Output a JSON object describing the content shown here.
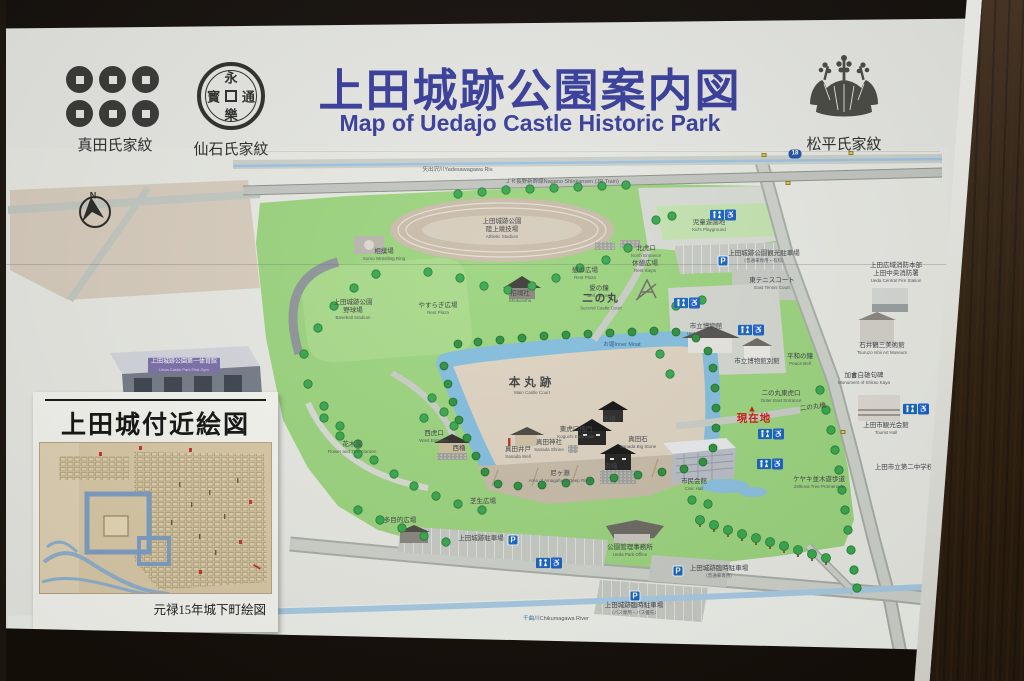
{
  "header": {
    "title": "上田城跡公園案内図",
    "subtitle": "Map of Uedajo Castle Historic Park",
    "title_color": "#383d9b",
    "crests": [
      {
        "id": "sanada",
        "label": "真田氏家紋"
      },
      {
        "id": "sengoku",
        "label": "仙石氏家紋",
        "coin": {
          "top": "永",
          "right": "通",
          "bottom": "樂",
          "left": "寳"
        }
      },
      {
        "id": "matsudaira",
        "label": "松平氏家紋"
      }
    ]
  },
  "inset": {
    "title": "上田城付近絵図",
    "caption": "元禄15年城下町絵図"
  },
  "colors": {
    "title_blue": "#383d9b",
    "park_green": "#9bd47e",
    "water_blue": "#84bede",
    "parking_blue": "#1766bf",
    "here_red": "#c81d10",
    "wood_brown": "#3b2b1c"
  },
  "map": {
    "parking_letter": "P",
    "wheelchair_icon": "♿",
    "you_are_here_marker": "▲",
    "route_shield": {
      "text": "18",
      "x": 795,
      "y": 154
    },
    "parkings": [
      {
        "x": 513,
        "y": 540
      },
      {
        "x": 678,
        "y": 571
      },
      {
        "x": 635,
        "y": 596
      },
      {
        "x": 723,
        "y": 261
      }
    ],
    "toilets": [
      {
        "x": 723,
        "y": 215
      },
      {
        "x": 687,
        "y": 303
      },
      {
        "x": 751,
        "y": 330
      },
      {
        "x": 771,
        "y": 434
      },
      {
        "x": 770,
        "y": 464
      },
      {
        "x": 549,
        "y": 563
      },
      {
        "x": 916,
        "y": 409
      }
    ],
    "signals": [
      {
        "x": 764,
        "y": 155
      },
      {
        "x": 851,
        "y": 153
      },
      {
        "x": 788,
        "y": 183
      },
      {
        "x": 843,
        "y": 432
      }
    ],
    "marker": {
      "x": 752,
      "y": 409
    },
    "labels": [
      {
        "jp": "N",
        "x": 93,
        "y": 196,
        "cls": "cn",
        "name": "compass-north-label"
      },
      {
        "jp": "矢出沢川",
        "en": "Yadesawagawa Riv.",
        "x": 458,
        "y": 167,
        "cls": "inline rd",
        "name": "river-road-label"
      },
      {
        "jp": "ＪＲ長野新幹線",
        "en": "Nagano Shinkansen (JR Train)",
        "x": 562,
        "y": 179,
        "cls": "inline rd",
        "name": "railway-label"
      },
      {
        "jp": "上田城跡公園",
        "jp2": "陸上競技場",
        "en": "Athletic Stadium",
        "x": 502,
        "y": 229
      },
      {
        "jp": "相撲場",
        "en": "Sumo Wrestling Ring",
        "x": 384,
        "y": 255
      },
      {
        "jp": "上田城跡公園",
        "jp2": "野球場",
        "en": "Baseball Stadium",
        "x": 353,
        "y": 310
      },
      {
        "jp": "やすらぎ広場",
        "en": "Rest Plaza",
        "x": 438,
        "y": 309
      },
      {
        "jp": "憩の広場",
        "en": "Rest Plaza",
        "x": 585,
        "y": 274
      },
      {
        "jp": "北虎口",
        "en": "North Entrance",
        "x": 646,
        "y": 252
      },
      {
        "jp": "休憩広場",
        "en": "Rest Steps",
        "x": 645,
        "y": 267
      },
      {
        "jp": "愛の鐘",
        "en": "Bell of Love",
        "x": 599,
        "y": 292
      },
      {
        "jp": "招魂社",
        "en": "Shokonsha",
        "x": 520,
        "y": 297
      },
      {
        "jp": "二の丸",
        "en": "Second Castle Court",
        "x": 601,
        "y": 302,
        "cls": "big"
      },
      {
        "jp": "お堀",
        "en": "Inner Moat",
        "x": 622,
        "y": 342,
        "cls": "inline wat"
      },
      {
        "jp": "本丸跡",
        "en": "Main Castle Court",
        "x": 532,
        "y": 386,
        "cls": "big sp"
      },
      {
        "jp": "西虎口",
        "en": "West Entrance",
        "x": 434,
        "y": 437
      },
      {
        "jp": "西櫓",
        "x": 459,
        "y": 449
      },
      {
        "jp": "真田神社",
        "en": "Sanada Shrine",
        "x": 549,
        "y": 446
      },
      {
        "jp": "真田井戸",
        "en": "Sanada Well",
        "x": 518,
        "y": 453
      },
      {
        "jp": "東虎口櫓門",
        "en": "Koguchi East Gate",
        "x": 576,
        "y": 433
      },
      {
        "jp": "北櫓",
        "x": 609,
        "y": 420
      },
      {
        "jp": "南櫓",
        "x": 611,
        "y": 467
      },
      {
        "jp": "真田石",
        "en": "Sanada Big Stone",
        "x": 638,
        "y": 443
      },
      {
        "jp": "尼ヶ淵",
        "en": "Area of Amagafuchi Deep River",
        "x": 560,
        "y": 477,
        "cls": "w64"
      },
      {
        "jp": "芝生広場",
        "x": 483,
        "y": 502
      },
      {
        "jp": "花木園",
        "en": "Flower and Tree Garden",
        "x": 352,
        "y": 448,
        "cls": "w64"
      },
      {
        "jp": "多目的広場",
        "x": 400,
        "y": 521
      },
      {
        "jp": "上田城跡駐車場",
        "x": 481,
        "y": 539
      },
      {
        "jp": "公園管理事務所",
        "en": "Ueda Park Office",
        "x": 630,
        "y": 551
      },
      {
        "jp": "上田城跡臨時駐車場",
        "en": "（バス専用・バス優先）",
        "x": 634,
        "y": 609
      },
      {
        "jp": "上田城跡臨時駐車場",
        "en": "（普通車専用）",
        "x": 719,
        "y": 572
      },
      {
        "jp": "千曲川",
        "en": "Chikumagawa River",
        "x": 556,
        "y": 616,
        "cls": "inline riv",
        "name": "chikuma-river-label"
      },
      {
        "jp": "児童遊園地",
        "en": "Kid's Playground",
        "x": 709,
        "y": 226
      },
      {
        "jp": "上田城跡公園観光駐車場",
        "en": "（普通車専用・有料）",
        "x": 764,
        "y": 257,
        "cls": "w74"
      },
      {
        "jp": "東テニスコート",
        "en": "East Tennis Court",
        "x": 772,
        "y": 284
      },
      {
        "jp": "市立博物館",
        "en": "Ueda City Museum",
        "x": 706,
        "y": 330
      },
      {
        "jp": "市立博物館別館",
        "x": 757,
        "y": 362
      },
      {
        "jp": "平和の鐘",
        "en": "Peace Bell",
        "x": 800,
        "y": 360
      },
      {
        "jp": "上田広域消防本部",
        "jp2": "上田中央消防署",
        "en": "Ueda Central Fire Station",
        "x": 896,
        "y": 273
      },
      {
        "jp": "石井鶴三美術館",
        "en": "Tsuruzo Ishii Art Museum",
        "x": 882,
        "y": 349,
        "cls": "w64"
      },
      {
        "jp": "加舎白雄句碑",
        "en": "Monument of Shirao Kaya",
        "x": 864,
        "y": 379,
        "cls": "w64"
      },
      {
        "jp": "上田市観光会館",
        "en": "Tourist Hall",
        "x": 886,
        "y": 429
      },
      {
        "jp": "上田市立第二中学校",
        "x": 904,
        "y": 468
      },
      {
        "jp": "現在地",
        "x": 754,
        "y": 419,
        "cls": "here",
        "name": "you-are-here-label"
      },
      {
        "jp": "二の丸橋",
        "x": 813,
        "y": 408,
        "cls": "rot"
      },
      {
        "jp": "二の丸東虎口",
        "en": "Outer East Entrance",
        "x": 781,
        "y": 397
      },
      {
        "jp": "ケヤキ並木遊歩道",
        "en": "Zelkova Tree Promenade",
        "x": 819,
        "y": 483,
        "cls": "w64"
      },
      {
        "jp": "市民会館",
        "en": "Civic Hall",
        "x": 694,
        "y": 485
      },
      {
        "jp": "上田城跡公園第一体育館",
        "en": "Ueda Castle Park First Gym",
        "x": 184,
        "y": 365,
        "cls": "gym"
      }
    ]
  }
}
